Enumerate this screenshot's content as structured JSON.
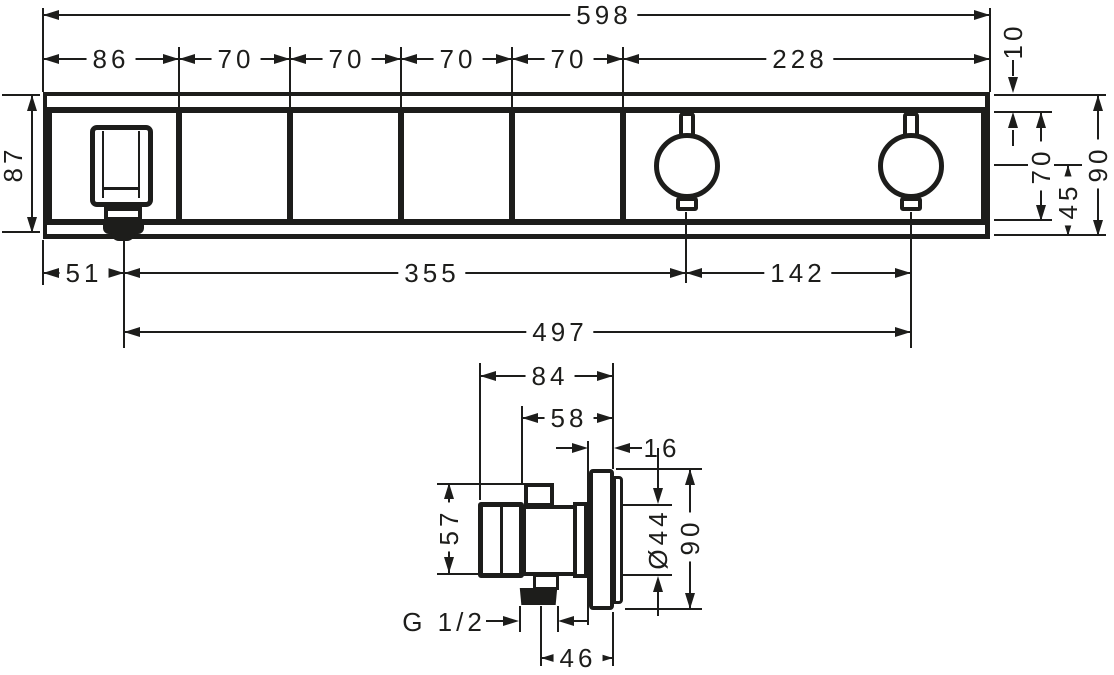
{
  "front": {
    "total": "598",
    "segments": [
      "86",
      "70",
      "70",
      "70",
      "70",
      "228"
    ],
    "height_left": "87",
    "top_offset": "10",
    "body_height": "70",
    "center_to_bottom": "45",
    "height_right": "90",
    "spout_offset": "51",
    "spout_to_knob1": "355",
    "knob_spacing": "142",
    "spout_to_knob2": "497"
  },
  "side": {
    "depth_total": "84",
    "depth_to_wall": "58",
    "plate_thickness": "16",
    "body_height": "57",
    "knob_diameter": "Ø44",
    "plate_height": "90",
    "thread": "G 1/2",
    "outlet_to_wall": "46"
  },
  "colors": {
    "ink": "#1d1d1b",
    "paper": "#ffffff"
  }
}
